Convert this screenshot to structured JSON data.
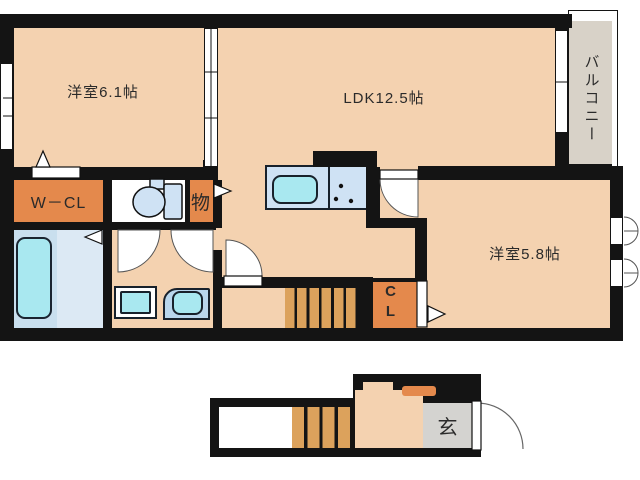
{
  "palette": {
    "wall": "#141414",
    "text": "#2a2a2a",
    "room": "#f4d2b0",
    "closet": "#e4894c",
    "step": "#dca25c",
    "balcony_gray": "#d8d2c8",
    "genkan_gray": "#d4d3d0",
    "bath_room": "#c9dfee",
    "bath_floor": "#dce9f4",
    "fixture_fill": "#cfe2f4",
    "cyan": "#a9e8f0",
    "vanity_blue": "#b9d6ec"
  },
  "floor2": {
    "bedroom1": {
      "label": "洋室6.1帖"
    },
    "ldk": {
      "label": "LDK12.5帖"
    },
    "balcony": {
      "label": "バルコニー"
    },
    "walk_in_closet": {
      "label": "W－CL"
    },
    "storage": {
      "label": "物"
    },
    "bedroom2": {
      "label": "洋室5.8帖"
    },
    "closet": {
      "line1": "C",
      "line2": "L"
    }
  },
  "floor1": {
    "entrance": {
      "label": "玄"
    }
  }
}
